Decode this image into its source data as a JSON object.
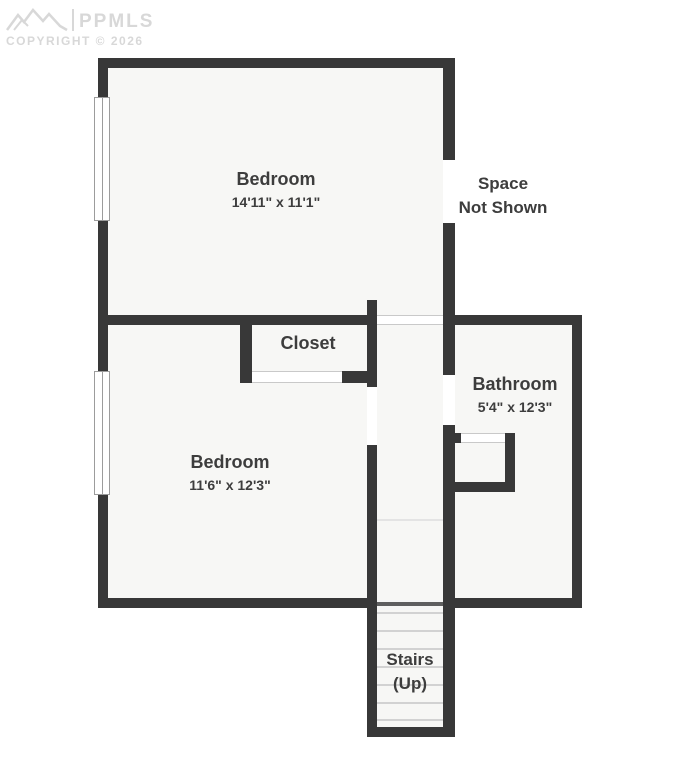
{
  "watermark": {
    "logo": "mountains-icon",
    "brand": "PPMLS",
    "copyright": "COPYRIGHT © 2026"
  },
  "space_not_shown": {
    "line1": "Space",
    "line2": "Not Shown"
  },
  "rooms": {
    "bedroom_upper": {
      "name": "Bedroom",
      "dims": "14'11\" x 11'1\""
    },
    "bedroom_lower": {
      "name": "Bedroom",
      "dims": "11'6\" x 12'3\""
    },
    "bathroom": {
      "name": "Bathroom",
      "dims": "5'4\" x 12'3\""
    },
    "closet": {
      "name": "Closet"
    },
    "stairs": {
      "name": "Stairs",
      "direction": "(Up)"
    }
  },
  "colors": {
    "wall": "#383838",
    "room_fill": "#f7f7f5",
    "text": "#3d3d3d",
    "tread": "#d2d2d2",
    "watermark": "#d8d8d8"
  }
}
